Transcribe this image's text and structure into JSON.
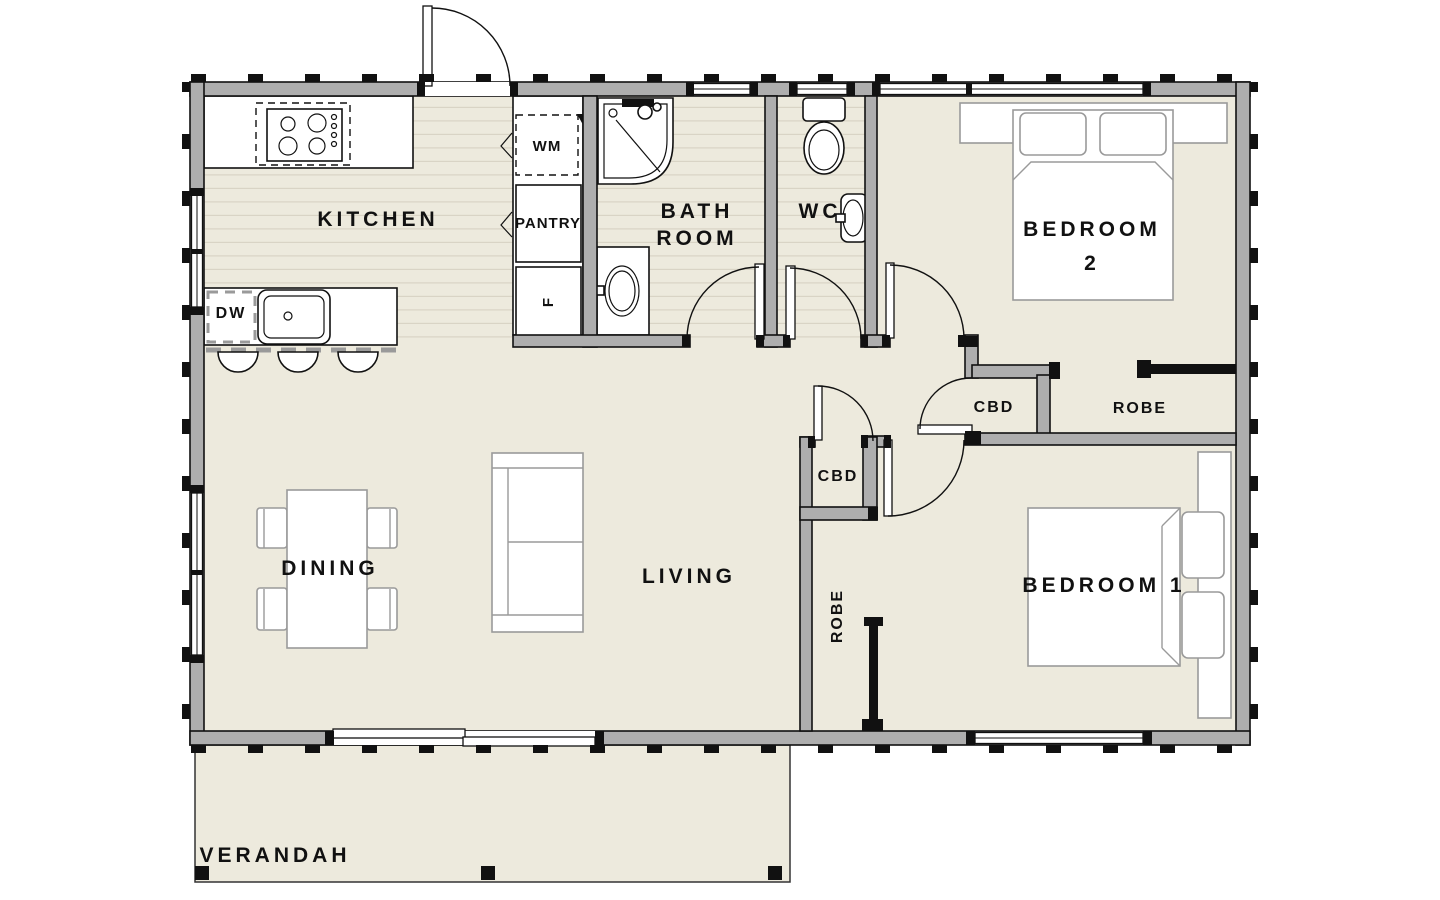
{
  "plan": {
    "labels": {
      "kitchen": "KITCHEN",
      "bathroom_line1": "BATH",
      "bathroom_line2": "ROOM",
      "wc": "WC",
      "bedroom2_line1": "BEDROOM",
      "bedroom2_line2": "2",
      "bedroom1": "BEDROOM 1",
      "dining": "DINING",
      "living": "LIVING",
      "verandah": "VERANDAH",
      "pantry": "PANTRY",
      "robe_bedroom2": "ROBE",
      "robe_bedroom1": "ROBE",
      "cbd_hall": "CBD",
      "cbd_living": "CBD",
      "washing_machine": "WM",
      "dishwasher": "DW",
      "fridge": "F"
    },
    "colors": {
      "wall_fill": "#aeaeae",
      "line": "#111111",
      "floor": "#edeadd",
      "floor_stripe": "#d9d4c5",
      "furniture_outline": "#9a9a9a"
    }
  }
}
